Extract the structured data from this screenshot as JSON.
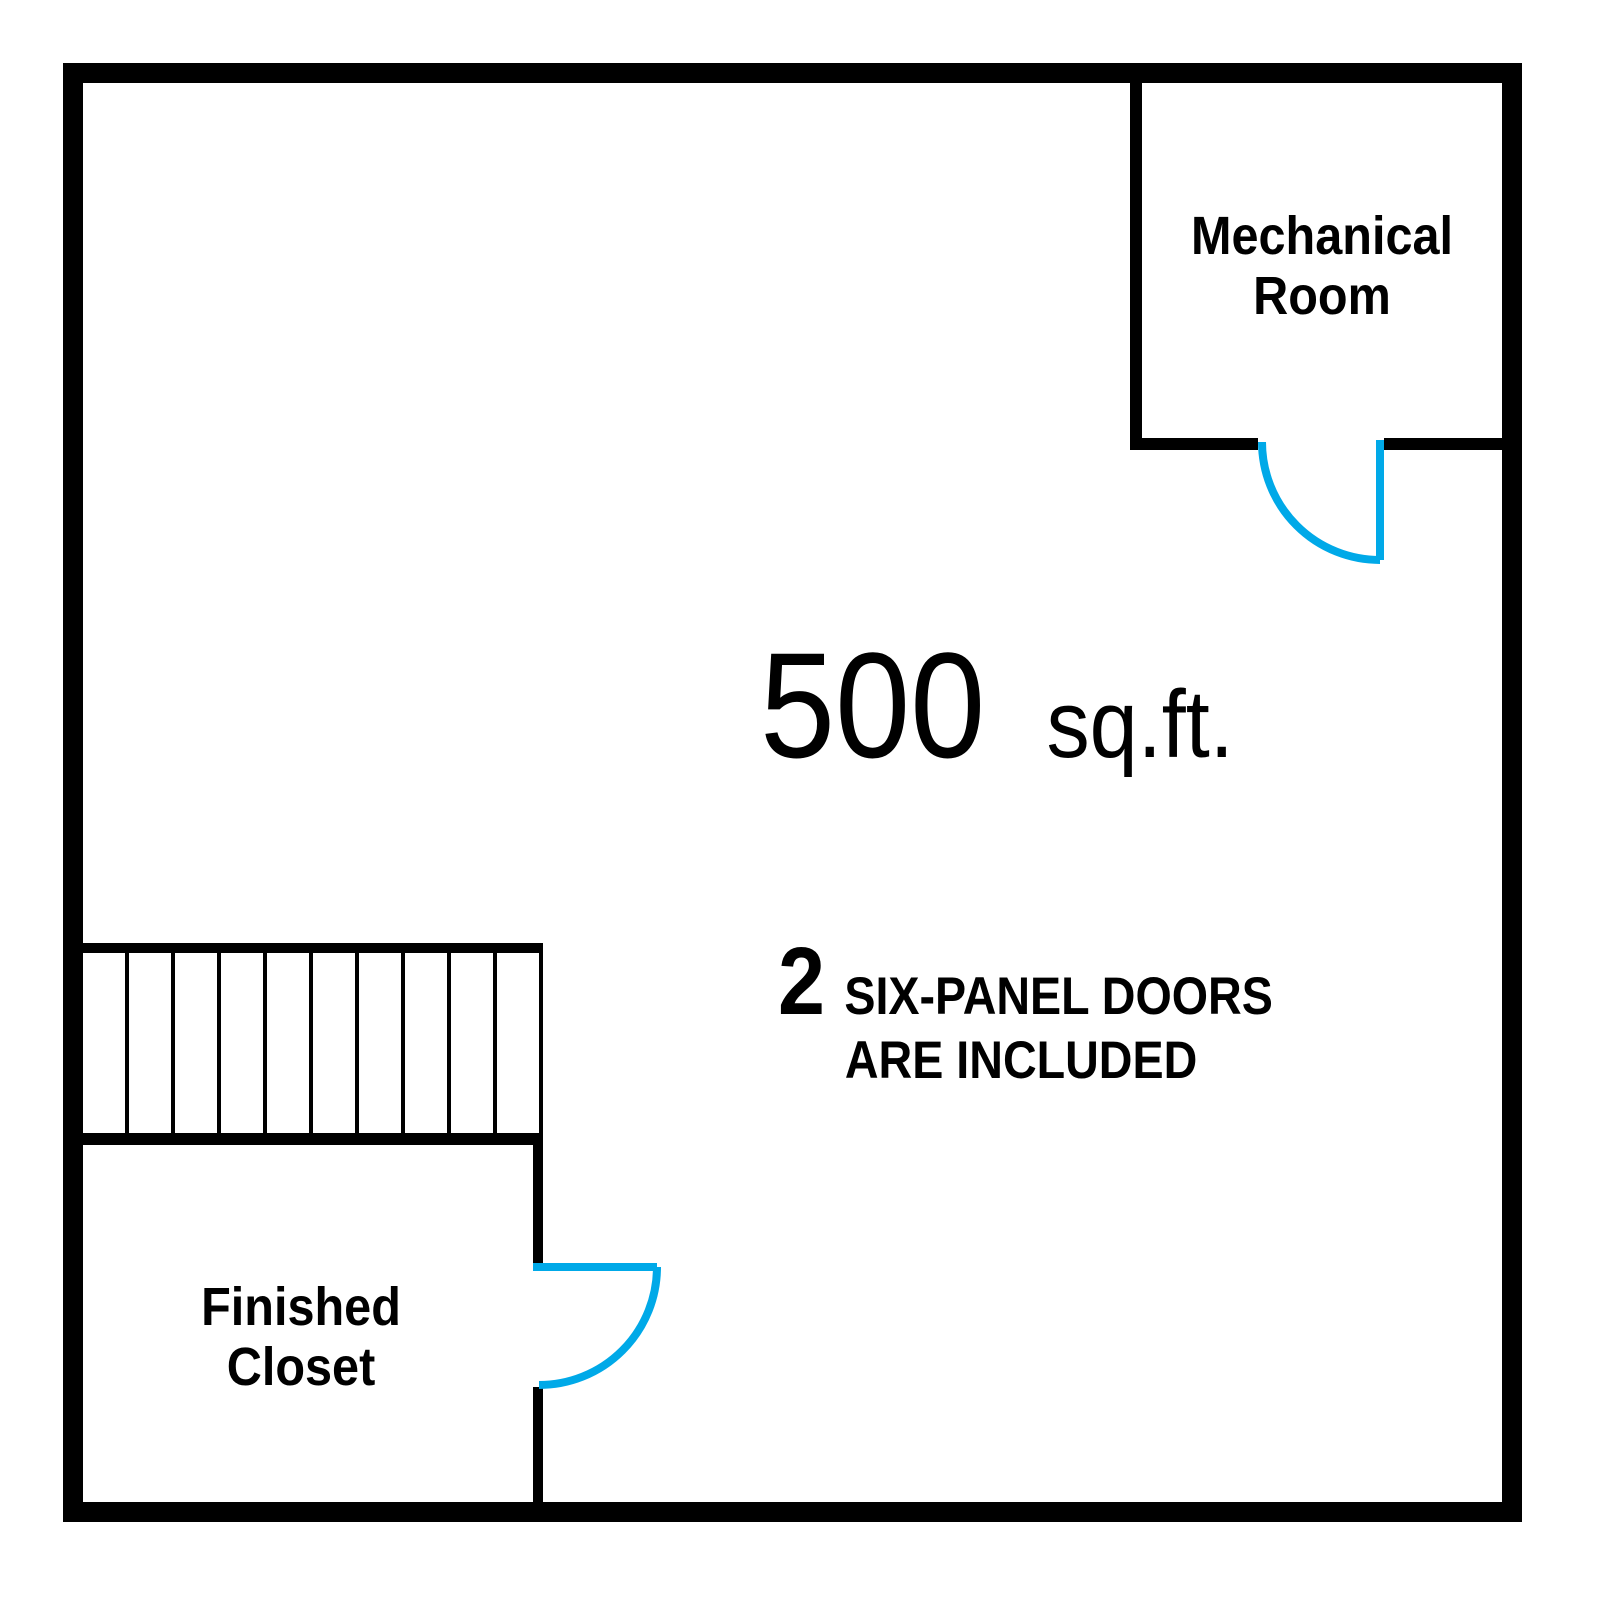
{
  "colors": {
    "walls": "#000000",
    "doors": "#00A9E8",
    "background": "#FFFFFF",
    "text": "#000000"
  },
  "rooms": {
    "mechanical": {
      "name": "Mechanical Room",
      "label_lines": [
        "Mechanical",
        "Room"
      ]
    },
    "closet": {
      "name": "Finished Closet",
      "label_lines": [
        "Finished",
        "Closet"
      ]
    }
  },
  "area_label": {
    "value": "500",
    "unit": "sq.ft."
  },
  "doors_note": {
    "count": "2",
    "text_line1": "SIX-PANEL DOORS",
    "text_line2": "ARE INCLUDED"
  },
  "stairs": {
    "tread_count": 10
  }
}
